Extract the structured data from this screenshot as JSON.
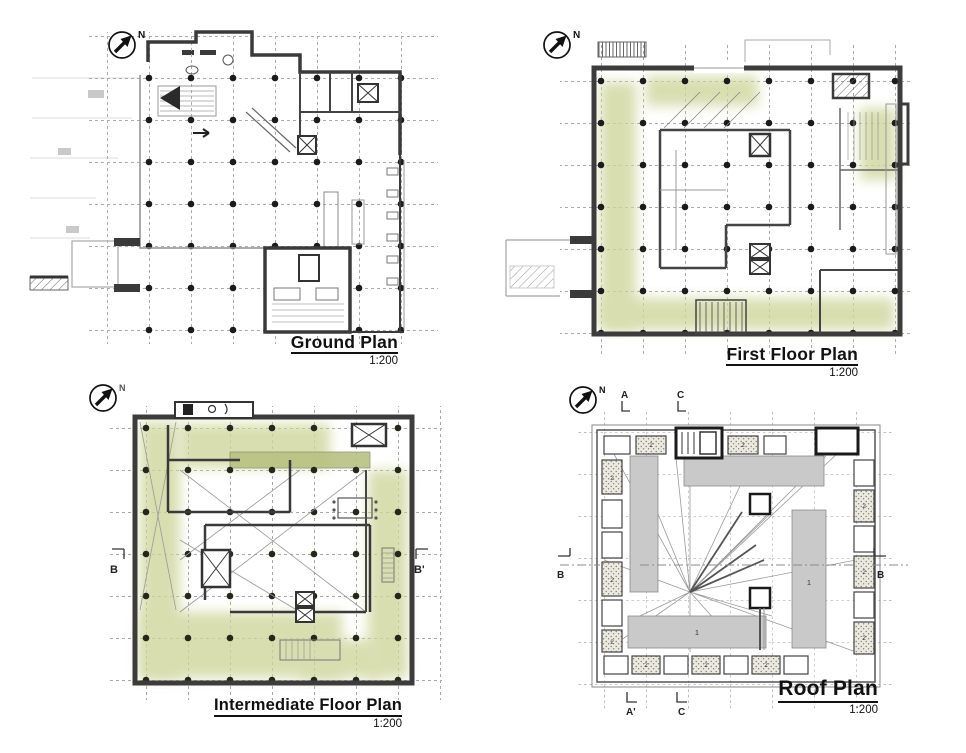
{
  "sheet": {
    "background": "#ffffff",
    "description": "Architectural plan sheet with four floor plans"
  },
  "compass": {
    "north": "N"
  },
  "panels": {
    "ground": {
      "title": "Ground Plan",
      "scale": "1:200"
    },
    "first_floor": {
      "title": "First Floor Plan",
      "scale": "1:200"
    },
    "intermediate": {
      "title": "Intermediate Floor Plan",
      "scale": "1:200"
    },
    "roof": {
      "title": "Roof Plan",
      "scale": "1:200"
    }
  },
  "section_markers": {
    "intermediate_left": "B",
    "intermediate_right": "B'",
    "roof_top_left": "A",
    "roof_top_right": "C",
    "roof_left": "B",
    "roof_right": "B",
    "roof_bottom_left": "A'",
    "roof_bottom_right": "C"
  },
  "annotations": {
    "roof_bar": "1",
    "roof_skylight": "2"
  },
  "colors": {
    "wall": "#3a3a3a",
    "grid": "#ababab",
    "column_dot": "#1b1b1b",
    "green_zone": "#cfd69c",
    "olive_bar": "#b8c182",
    "roof_fill": "#c9c9c9"
  }
}
